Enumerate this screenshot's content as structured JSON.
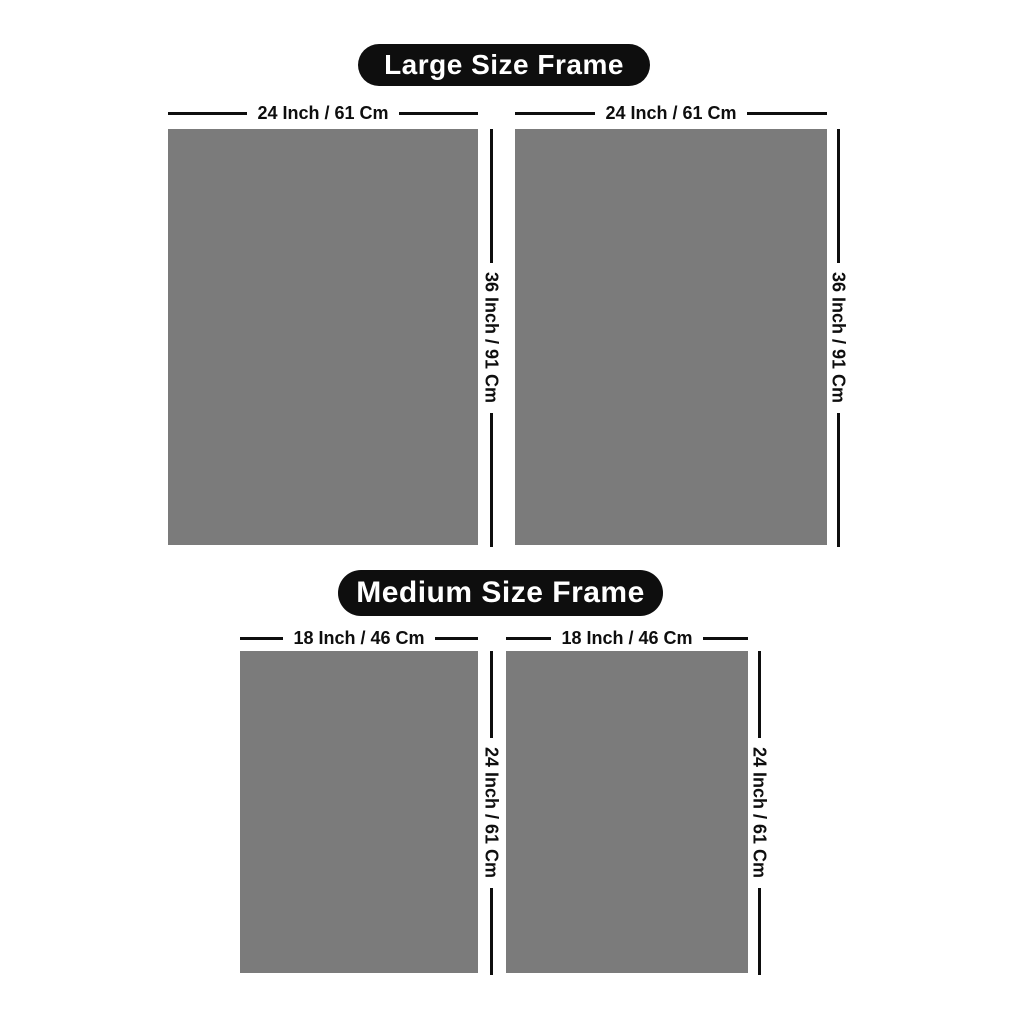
{
  "colors": {
    "background": "#ffffff",
    "frame_fill": "#7b7b7b",
    "badge_background": "#0e0e0e",
    "badge_text": "#ffffff",
    "dimension_line": "#0e0e0e"
  },
  "sections": [
    {
      "title": "Large Size Frame",
      "frames": [
        {
          "width_label": "24 Inch / 61 Cm",
          "height_label": "36 Inch / 91 Cm"
        },
        {
          "width_label": "24 Inch / 61 Cm",
          "height_label": "36 Inch / 91 Cm"
        }
      ]
    },
    {
      "title": "Medium Size Frame",
      "frames": [
        {
          "width_label": "18 Inch / 46 Cm",
          "height_label": "24 Inch / 61 Cm"
        },
        {
          "width_label": "18 Inch / 46 Cm",
          "height_label": "24 Inch / 61 Cm"
        }
      ]
    }
  ]
}
